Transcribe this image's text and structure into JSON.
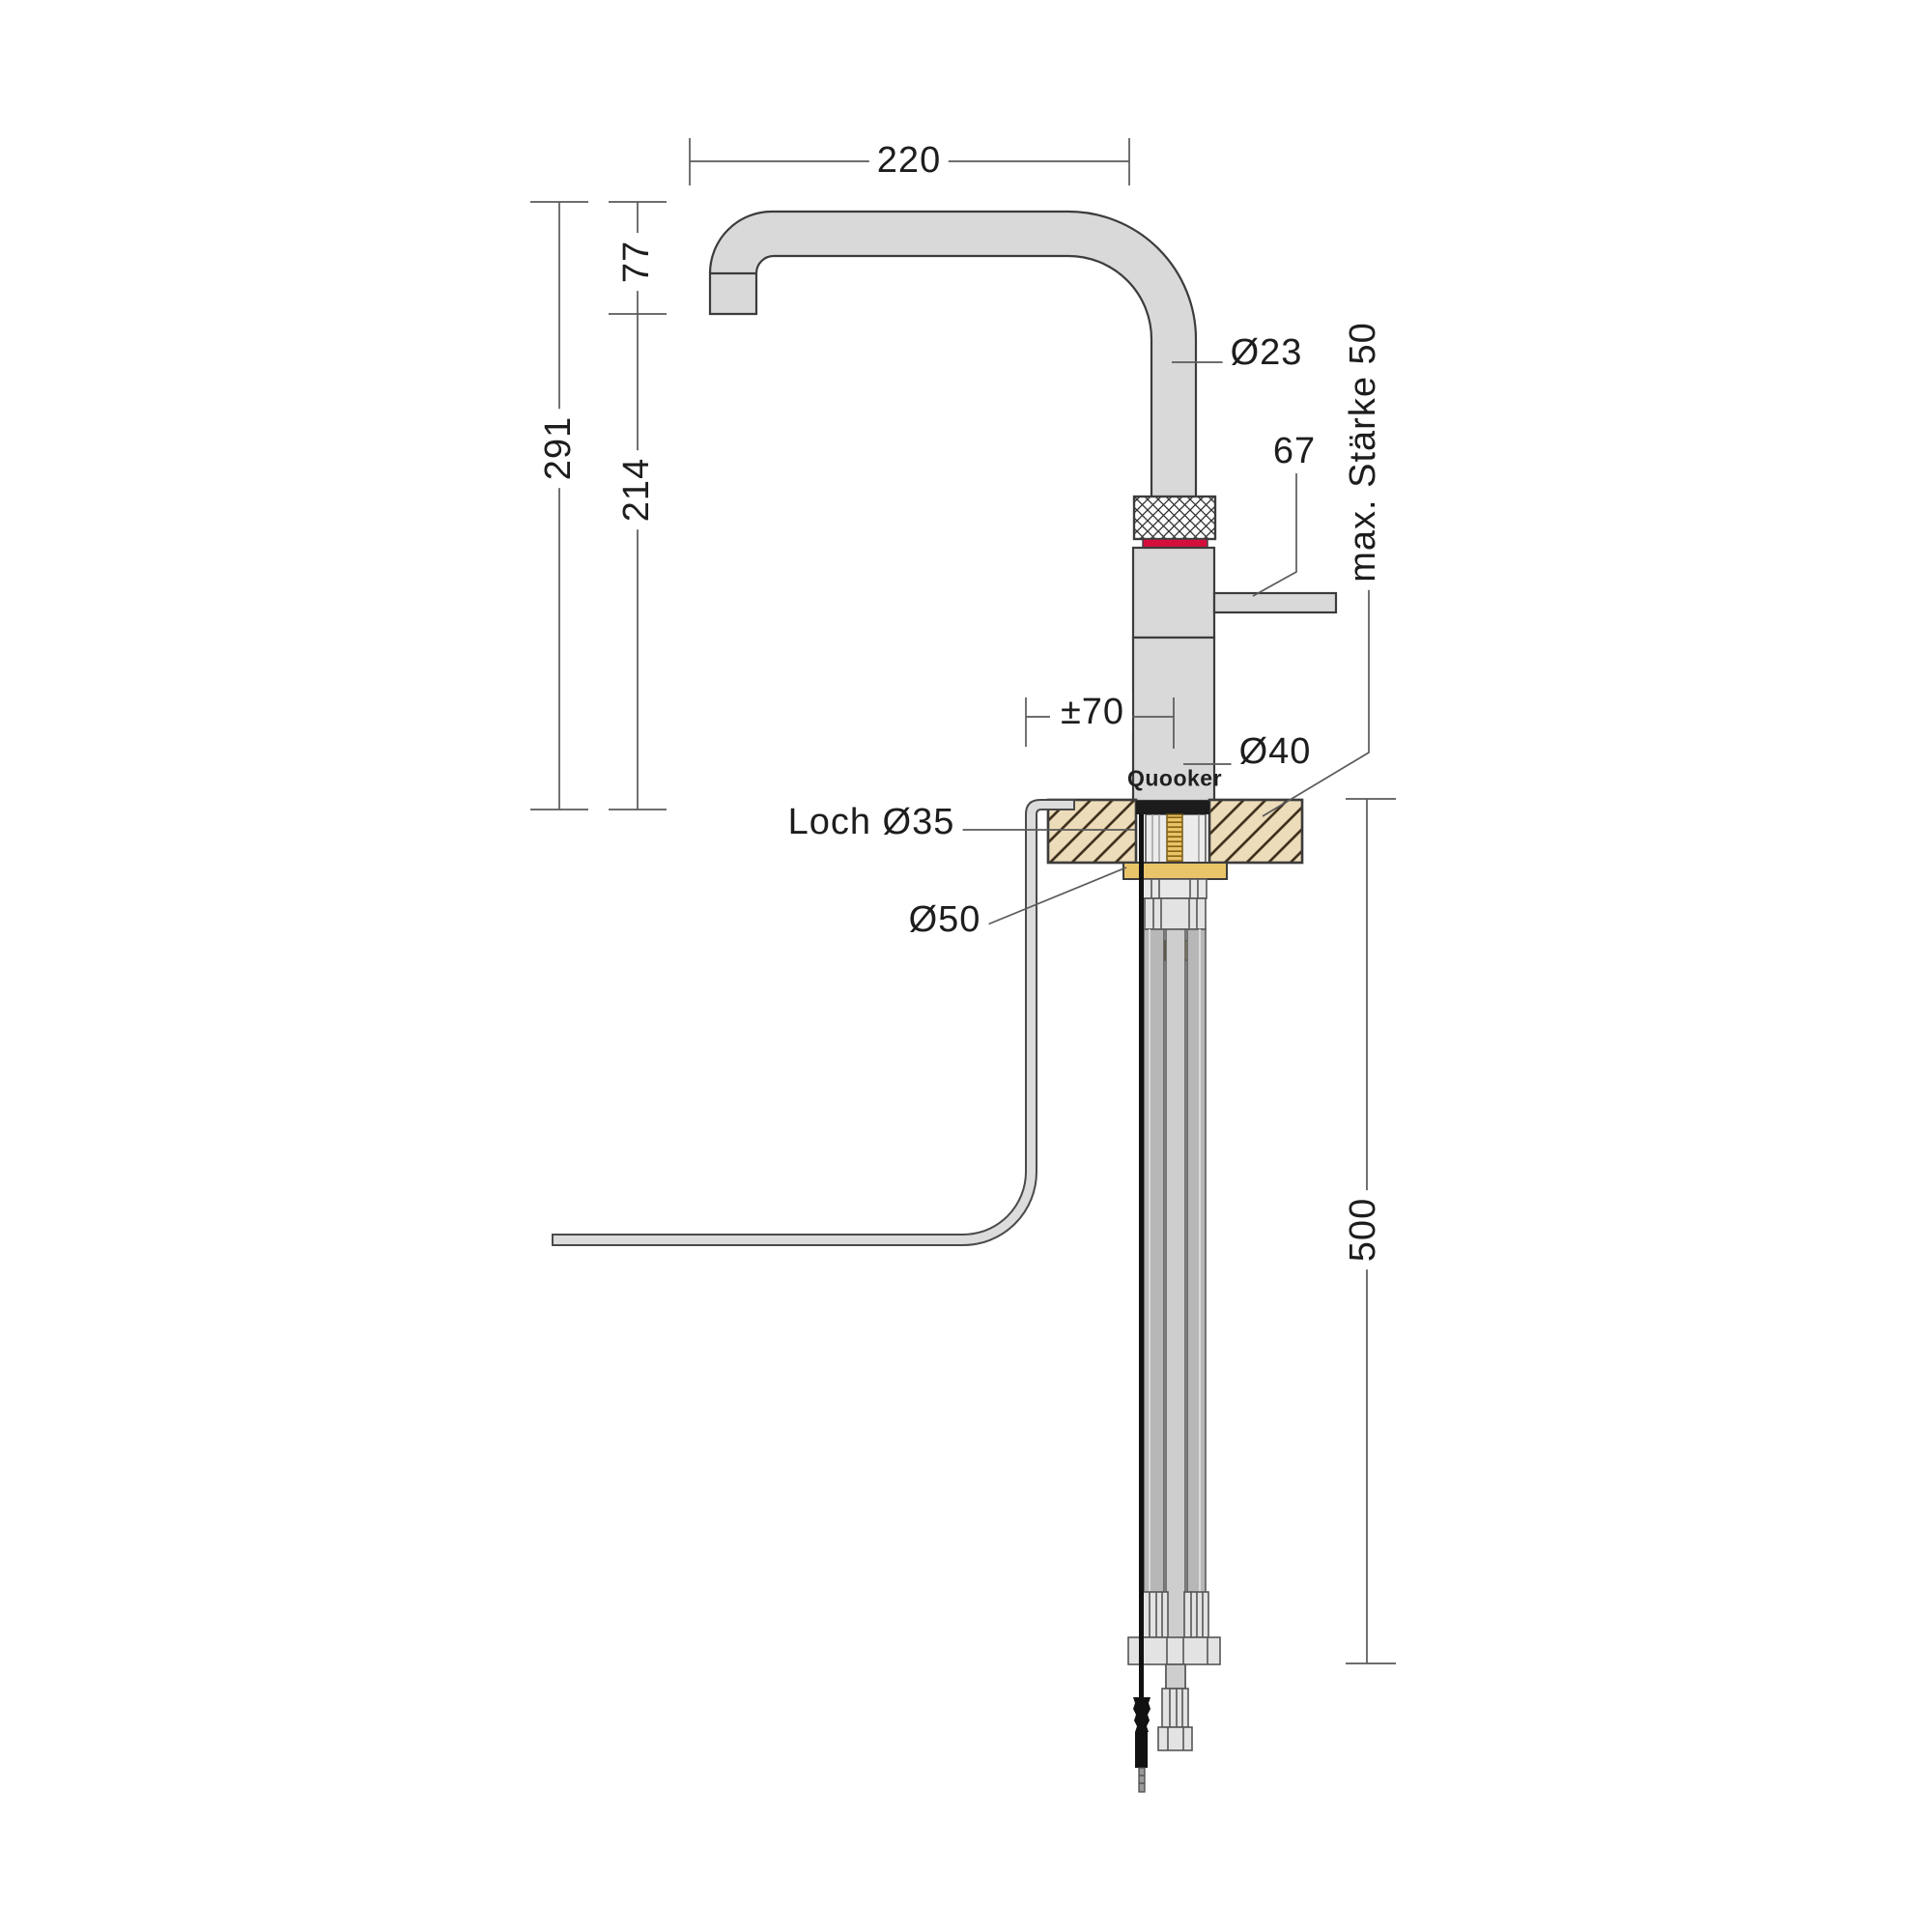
{
  "drawing": {
    "brand_logo": "Quooker",
    "kind": "faucet installation dimension drawing"
  },
  "labels": {
    "spout_reach": "220",
    "spout_drop": "77",
    "total_height": "291",
    "spout_clearance": "214",
    "spout_diameter": "Ø23",
    "handle_length": "67",
    "max_counter_thickness": "max. Stärke 50",
    "swivel_offset": "±70",
    "body_diameter": "Ø40",
    "hole_diameter": "Loch Ø35",
    "flange_diameter": "Ø50",
    "under_counter_depth": "500"
  },
  "colors": {
    "red": "#d40f3c",
    "brass": "#e9c469",
    "brass-dark": "#8a6413",
    "counter": "#eddcba",
    "counter-line": "#3a2c19",
    "steel-light": "#d9d9d9",
    "steel-mid": "#b7b7b7",
    "steel-pale": "#e3e3e3",
    "hose": "#dcdcdc",
    "outline": "#3c3c3c",
    "dim-line": "#5a5a5a",
    "text": "#1d1d1d",
    "black-part": "#1c1c1c"
  }
}
